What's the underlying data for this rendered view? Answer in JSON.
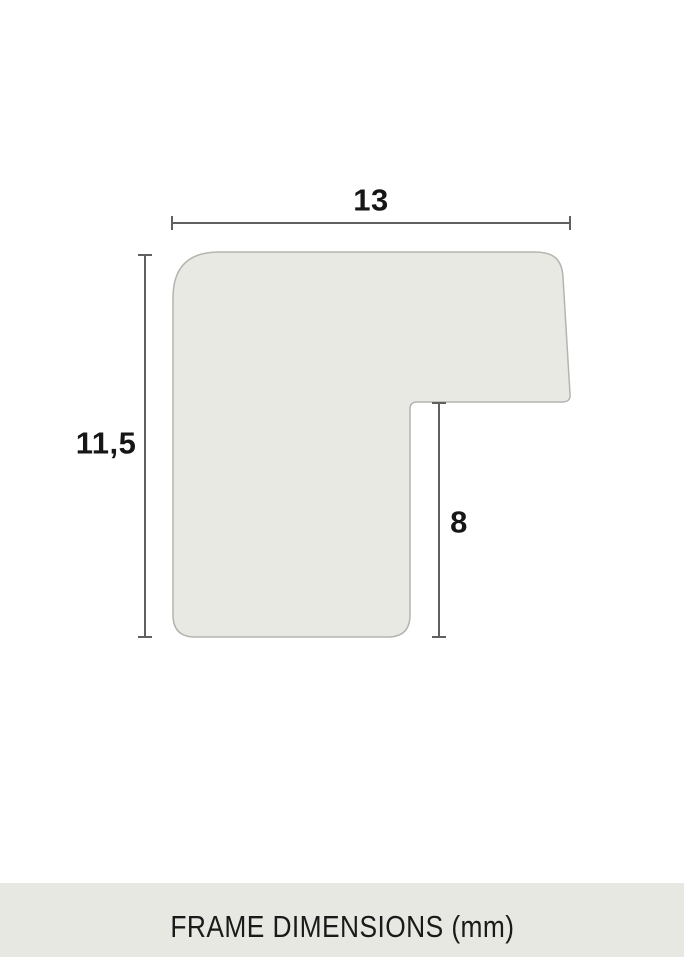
{
  "diagram": {
    "width_label": "13",
    "height_label": "11,5",
    "depth_label": "8",
    "caption": "FRAME DIMENSIONS (mm)",
    "units": "mm",
    "colors": {
      "background": "#ffffff",
      "profile_fill": "#e9e9e4",
      "profile_stroke": "#b4b4b0",
      "dimension_line": "#606060",
      "label_text": "#161616",
      "caption_bg": "#e8e8e3",
      "caption_text": "#1a1a1a"
    }
  }
}
